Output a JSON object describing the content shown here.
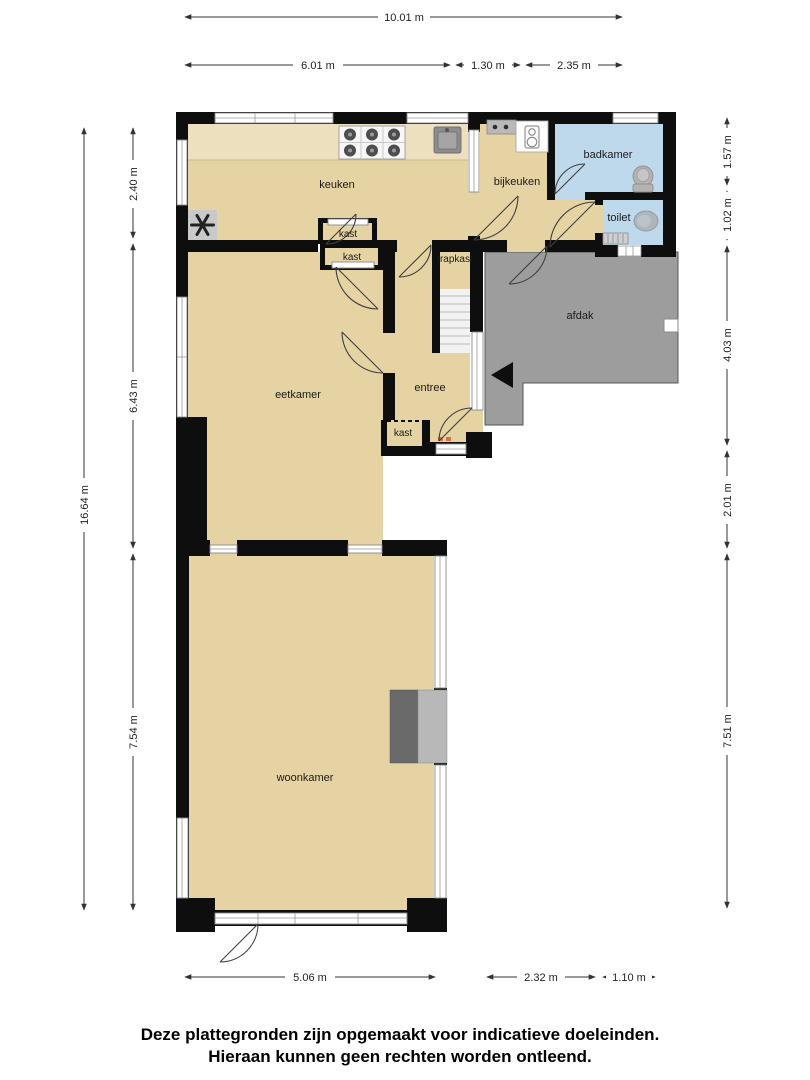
{
  "plan": {
    "rooms": [
      {
        "id": "keuken",
        "label": "keuken"
      },
      {
        "id": "bijkeuken",
        "label": "bijkeuken"
      },
      {
        "id": "badkamer",
        "label": "badkamer"
      },
      {
        "id": "toilet",
        "label": "toilet"
      },
      {
        "id": "kast-keuken",
        "label": "kast"
      },
      {
        "id": "kast-eetkamer",
        "label": "kast"
      },
      {
        "id": "trapkast",
        "label": "trapkast"
      },
      {
        "id": "afdak",
        "label": "afdak"
      },
      {
        "id": "eetkamer",
        "label": "eetkamer"
      },
      {
        "id": "entree",
        "label": "entree"
      },
      {
        "id": "kast-entree",
        "label": "kast"
      },
      {
        "id": "woonkamer",
        "label": "woonkamer"
      }
    ],
    "fixtures": [
      "stove",
      "sink",
      "extractor-fan",
      "kitchen-counter",
      "washing-machine",
      "toilet-in-badkamer",
      "toilet-bowl",
      "hand-basin-radiator",
      "stairs",
      "fireplace",
      "entrance-arrow",
      "vent"
    ],
    "colors": {
      "floor": "#e5d3a4",
      "counter": "#ece0bf",
      "wet_room": "#bfd9ec",
      "outdoor": "#9d9d9d",
      "wall": "#0e0e0e",
      "fixture_gray": "#b3b3b3"
    }
  },
  "dimensions": {
    "top": [
      {
        "label": "10.01 m"
      },
      {
        "label": "6.01 m"
      },
      {
        "label": "1.30 m"
      },
      {
        "label": "2.35 m"
      }
    ],
    "left": [
      {
        "label": "16.64 m"
      },
      {
        "label": "2.40 m"
      },
      {
        "label": "6.43 m"
      },
      {
        "label": "7.54 m"
      }
    ],
    "right": [
      {
        "label": "1.57 m"
      },
      {
        "label": "1.02 m"
      },
      {
        "label": "4.03 m"
      },
      {
        "label": "2.01 m"
      },
      {
        "label": "7.51 m"
      }
    ],
    "bottom": [
      {
        "label": "5.06 m"
      },
      {
        "label": "2.32 m"
      },
      {
        "label": "1.10 m"
      }
    ]
  },
  "disclaimer": {
    "line1": "Deze plattegronden zijn opgemaakt voor indicatieve doeleinden.",
    "line2": "Hieraan kunnen geen rechten worden ontleend."
  }
}
